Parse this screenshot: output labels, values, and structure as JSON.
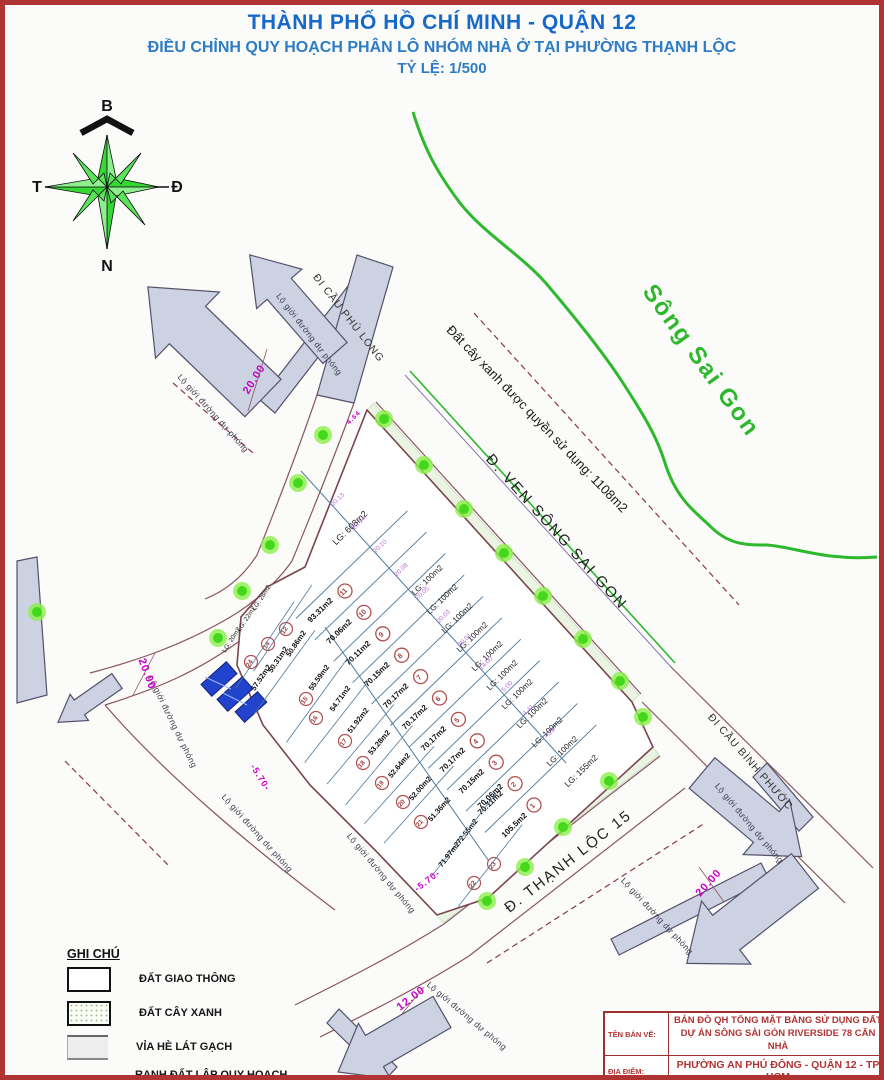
{
  "header": {
    "title": "THÀNH PHỐ HỒ CHÍ MINH - QUẬN 12",
    "subtitle": "ĐIỀU CHỈNH QUY HOẠCH PHÂN LÔ NHÓM NHÀ Ở TẠI PHƯỜNG THẠNH LỘC",
    "scale": "TỶ LỆ: 1/500"
  },
  "compass": {
    "north": "B",
    "east": "Đ",
    "south": "N",
    "west": "T"
  },
  "river": {
    "label": "Sông Sai Gon"
  },
  "map_labels": {
    "green_area": "Đất cây xanh được quyền sử dụng: 1108m2",
    "road_ven_song": "Đ. VEN SÔNG SAI GON",
    "road_thanh_loc": "Đ. THẠNH LỘC 15",
    "to_phu_long": "ĐI CẦU PHÚ LONG",
    "to_binh_phuoc": "ĐI CẦU BÌNH PHƯỚC",
    "lo_gioi": "Lộ giới đường dự phóng"
  },
  "dimensions": {
    "d20": "20.00",
    "d12": "12.00",
    "d570": "-5.70-",
    "d464": "4.64"
  },
  "edge_dims": [
    "20.13",
    "20.14",
    "20.10",
    "20.08",
    "20.05",
    "20.03",
    "20.01",
    "14.00",
    "5.00",
    "4.41",
    "7.29"
  ],
  "lots": {
    "top_lot": "LG: 608m2",
    "small": [
      "LG: 28m2",
      "LG: 22m2",
      "LG: 20m2"
    ],
    "right": [
      "LG: 100m2",
      "LG: 100m2",
      "LG: 100m2",
      "LG: 100m2",
      "LG: 100m2",
      "LG: 100m2",
      "LG: 100m2",
      "LG: 100m2",
      "LG: 100m2",
      "LG: 100m2"
    ],
    "right_last": "LG: 155m2",
    "middle": [
      {
        "no": "11",
        "area": "93.31m2"
      },
      {
        "no": "10",
        "area": "70.06m2"
      },
      {
        "no": "9",
        "area": "70.11m2"
      },
      {
        "no": "8",
        "area": "70.15m2"
      },
      {
        "no": "7",
        "area": "70.17m2"
      },
      {
        "no": "6",
        "area": "70.17m2"
      },
      {
        "no": "5",
        "area": "70.17m2"
      },
      {
        "no": "4",
        "area": "70.17m2"
      },
      {
        "no": "3",
        "area": "70.15m2"
      },
      {
        "no": "2",
        "area": "70.11m2"
      },
      {
        "no": "",
        "area": "70.06m2"
      },
      {
        "no": "1",
        "area": "105.5m2"
      }
    ],
    "left": [
      {
        "no": "12",
        "area": "50.86m2"
      },
      {
        "no": "14",
        "area": "50.31m2"
      },
      {
        "no": "24",
        "area": "57.52m2"
      },
      {
        "no": "15",
        "area": "55.59m2"
      },
      {
        "no": "16",
        "area": "54.71m2"
      },
      {
        "no": "17",
        "area": "51.92m2"
      },
      {
        "no": "18",
        "area": "53.28m2"
      },
      {
        "no": "19",
        "area": "52.64m2"
      },
      {
        "no": "20",
        "area": "52.00m2"
      },
      {
        "no": "21",
        "area": "51.36m2"
      },
      {
        "no": "23",
        "area": "72.55m2"
      },
      {
        "no": "22",
        "area": "71.97m2"
      }
    ]
  },
  "legend": {
    "title": "GHI CHÚ",
    "item1": "ĐẤT GIAO THÔNG",
    "item2": "ĐẤT CÂY XANH",
    "item3": "VỈA HÈ LÁT GẠCH",
    "item4a": "RANH ĐẤT LẬP QUY HOẠCH",
    "item4b": "TỔNG MẶT BẰNG"
  },
  "title_block": {
    "row1_label": "TÊN BẢN VẼ:",
    "row1_line1": "BẢN ĐỒ QH TỔNG MẶT BẰNG SỬ DỤNG ĐẤT",
    "row1_line2": "DỰ ÁN SÔNG SÀI GÒN RIVERSIDE 78 CĂN NHÀ",
    "row2_label": "ĐỊA ĐIỂM:",
    "row2_value": "PHƯỜNG AN PHÚ ĐÔNG - QUẬN 12 - TP HCM"
  },
  "colors": {
    "title_blue": "#1669c9",
    "river_green": "#2db82d",
    "dim_magenta": "#cc00cc",
    "lot_line_blue": "#4d7a9e",
    "road_brown": "#8a5560",
    "circle_red": "#a04040",
    "arrow_gray": "#ccd2e2",
    "frame_red": "#b13434",
    "building_blue": "#2244cc"
  }
}
